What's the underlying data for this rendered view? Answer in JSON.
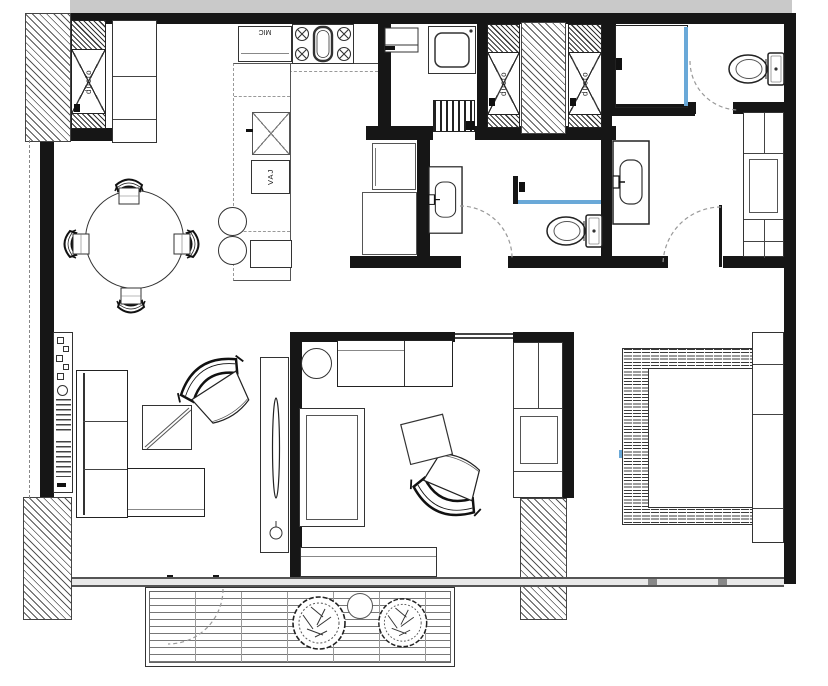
{
  "page": {
    "kind": "apartment floor plan drawing",
    "width_px": 828,
    "height_px": 686
  },
  "labels": {
    "duct_shaft": "ducto",
    "microwave_cabinet": "MIC",
    "dish_cabinet": "VAJ"
  },
  "colors": {
    "background": "#ffffff",
    "wall": "#161616",
    "adjacent_unit_band": "#c9c9c9",
    "shower_glass": "#6aa9d8",
    "hatch_line": "#555555",
    "window_frame": "#555555"
  }
}
